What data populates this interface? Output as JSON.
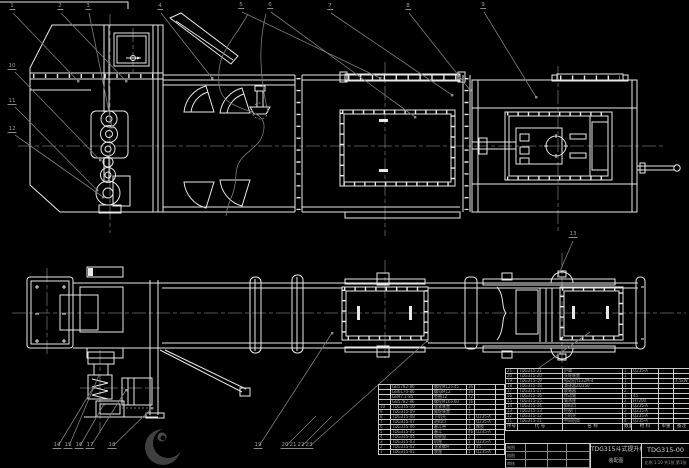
{
  "drawing": {
    "title": "TDG315斗式提升机",
    "subtitle": "装配图",
    "drawing_number": "TDG315-00",
    "scale_row": "比例 1:10  共1张 第1张",
    "sign_labels": [
      "制图",
      "描图",
      "审核"
    ]
  },
  "colors": {
    "background": "#000000",
    "line": "#e8e8e8",
    "annotation": "#8a8a8a",
    "centerline": "#6f6f6f",
    "table_text": "#aaaaaa"
  },
  "bom": {
    "header": [
      "序号",
      "代  号",
      "名  称",
      "数量",
      "材 料",
      "单重",
      "备注"
    ],
    "right_rows": [
      [
        "21",
        "TDG315-21",
        "护罩",
        "1",
        "Q235-A",
        "",
        ""
      ],
      [
        "20",
        "TDG315-20",
        "头轮装置",
        "1",
        "",
        "",
        ""
      ],
      [
        "19",
        "TDG315-19",
        "电动机Y132M-4",
        "1",
        "",
        "",
        "7.5kW"
      ],
      [
        "18",
        "TDG315-18",
        "减速器ZQ350",
        "1",
        "",
        "",
        ""
      ],
      [
        "17",
        "TDG315-17",
        "联轴器",
        "2",
        "",
        "",
        ""
      ],
      [
        "16",
        "TDG315-16",
        "传动轴",
        "1",
        "45",
        "",
        ""
      ],
      [
        "15",
        "TDG315-15",
        "轴承座",
        "2",
        "HT200",
        "",
        ""
      ],
      [
        "14",
        "TDG315-14",
        "卸料口",
        "1",
        "Q235-A",
        "",
        ""
      ],
      [
        "13",
        "TDG315-13",
        "检视门",
        "2",
        "Q235-A",
        "",
        ""
      ],
      [
        "12",
        "TDG315-12",
        "上机壳",
        "1",
        "Q235-A",
        "",
        ""
      ],
      [
        "11",
        "TDG315-11",
        "中间机筒",
        "4",
        "Q235-A",
        "",
        ""
      ]
    ],
    "left_rows": [
      [
        "",
        "GB5782-86",
        "螺栓M12×45",
        "36",
        "",
        ""
      ],
      [
        "",
        "GB6170-86",
        "螺母M12",
        "36",
        "",
        ""
      ],
      [
        "",
        "GB97.1-85",
        "垫圈12",
        "72",
        "",
        ""
      ],
      [
        "",
        "GB5782-86",
        "螺栓M16×60",
        "16",
        "",
        ""
      ],
      [
        "10",
        "TDG315-10",
        "张紧装置",
        "1",
        "",
        ""
      ],
      [
        "9",
        "TDG315-09",
        "尾轮装置",
        "1",
        "",
        ""
      ],
      [
        "8",
        "TDG315-08",
        "下机壳",
        "1",
        "Q235-A",
        ""
      ],
      [
        "7",
        "TDG315-07",
        "进料口",
        "1",
        "Q235-A",
        ""
      ],
      [
        "6",
        "TDG315-06",
        "畚斗带",
        "1",
        "橡胶",
        ""
      ],
      [
        "5",
        "TDG315-05",
        "畚斗",
        "46",
        "Q235-A",
        ""
      ],
      [
        "4",
        "TDG315-04",
        "观察窗",
        "1",
        "",
        ""
      ],
      [
        "3",
        "TDG315-03",
        "机座",
        "1",
        "Q235-A",
        ""
      ],
      [
        "2",
        "TDG315-02",
        "张紧螺杆",
        "2",
        "45",
        ""
      ],
      [
        "1",
        "TDG315-01",
        "底座",
        "1",
        "Q235-A",
        ""
      ]
    ]
  },
  "balloons": [
    {
      "n": "1",
      "x": 12,
      "y": 10
    },
    {
      "n": "2",
      "x": 60,
      "y": 10
    },
    {
      "n": "3",
      "x": 88,
      "y": 10
    },
    {
      "n": "4",
      "x": 160,
      "y": 10
    },
    {
      "n": "5",
      "x": 241,
      "y": 9
    },
    {
      "n": "6",
      "x": 270,
      "y": 9
    },
    {
      "n": "7",
      "x": 330,
      "y": 10
    },
    {
      "n": "8",
      "x": 408,
      "y": 10
    },
    {
      "n": "9",
      "x": 483,
      "y": 9
    },
    {
      "n": "10",
      "x": 12,
      "y": 70
    },
    {
      "n": "11",
      "x": 12,
      "y": 105
    },
    {
      "n": "12",
      "x": 12,
      "y": 133
    },
    {
      "n": "13",
      "x": 573,
      "y": 238
    },
    {
      "n": "14",
      "x": 57,
      "y": 449
    },
    {
      "n": "15",
      "x": 68,
      "y": 449
    },
    {
      "n": "16",
      "x": 79,
      "y": 449
    },
    {
      "n": "17",
      "x": 90,
      "y": 449
    },
    {
      "n": "18",
      "x": 112,
      "y": 449
    },
    {
      "n": "19",
      "x": 258,
      "y": 449
    },
    {
      "n": "20",
      "x": 285,
      "y": 449
    },
    {
      "n": "21",
      "x": 293,
      "y": 449
    },
    {
      "n": "22",
      "x": 301,
      "y": 449
    },
    {
      "n": "23",
      "x": 309,
      "y": 449
    }
  ]
}
